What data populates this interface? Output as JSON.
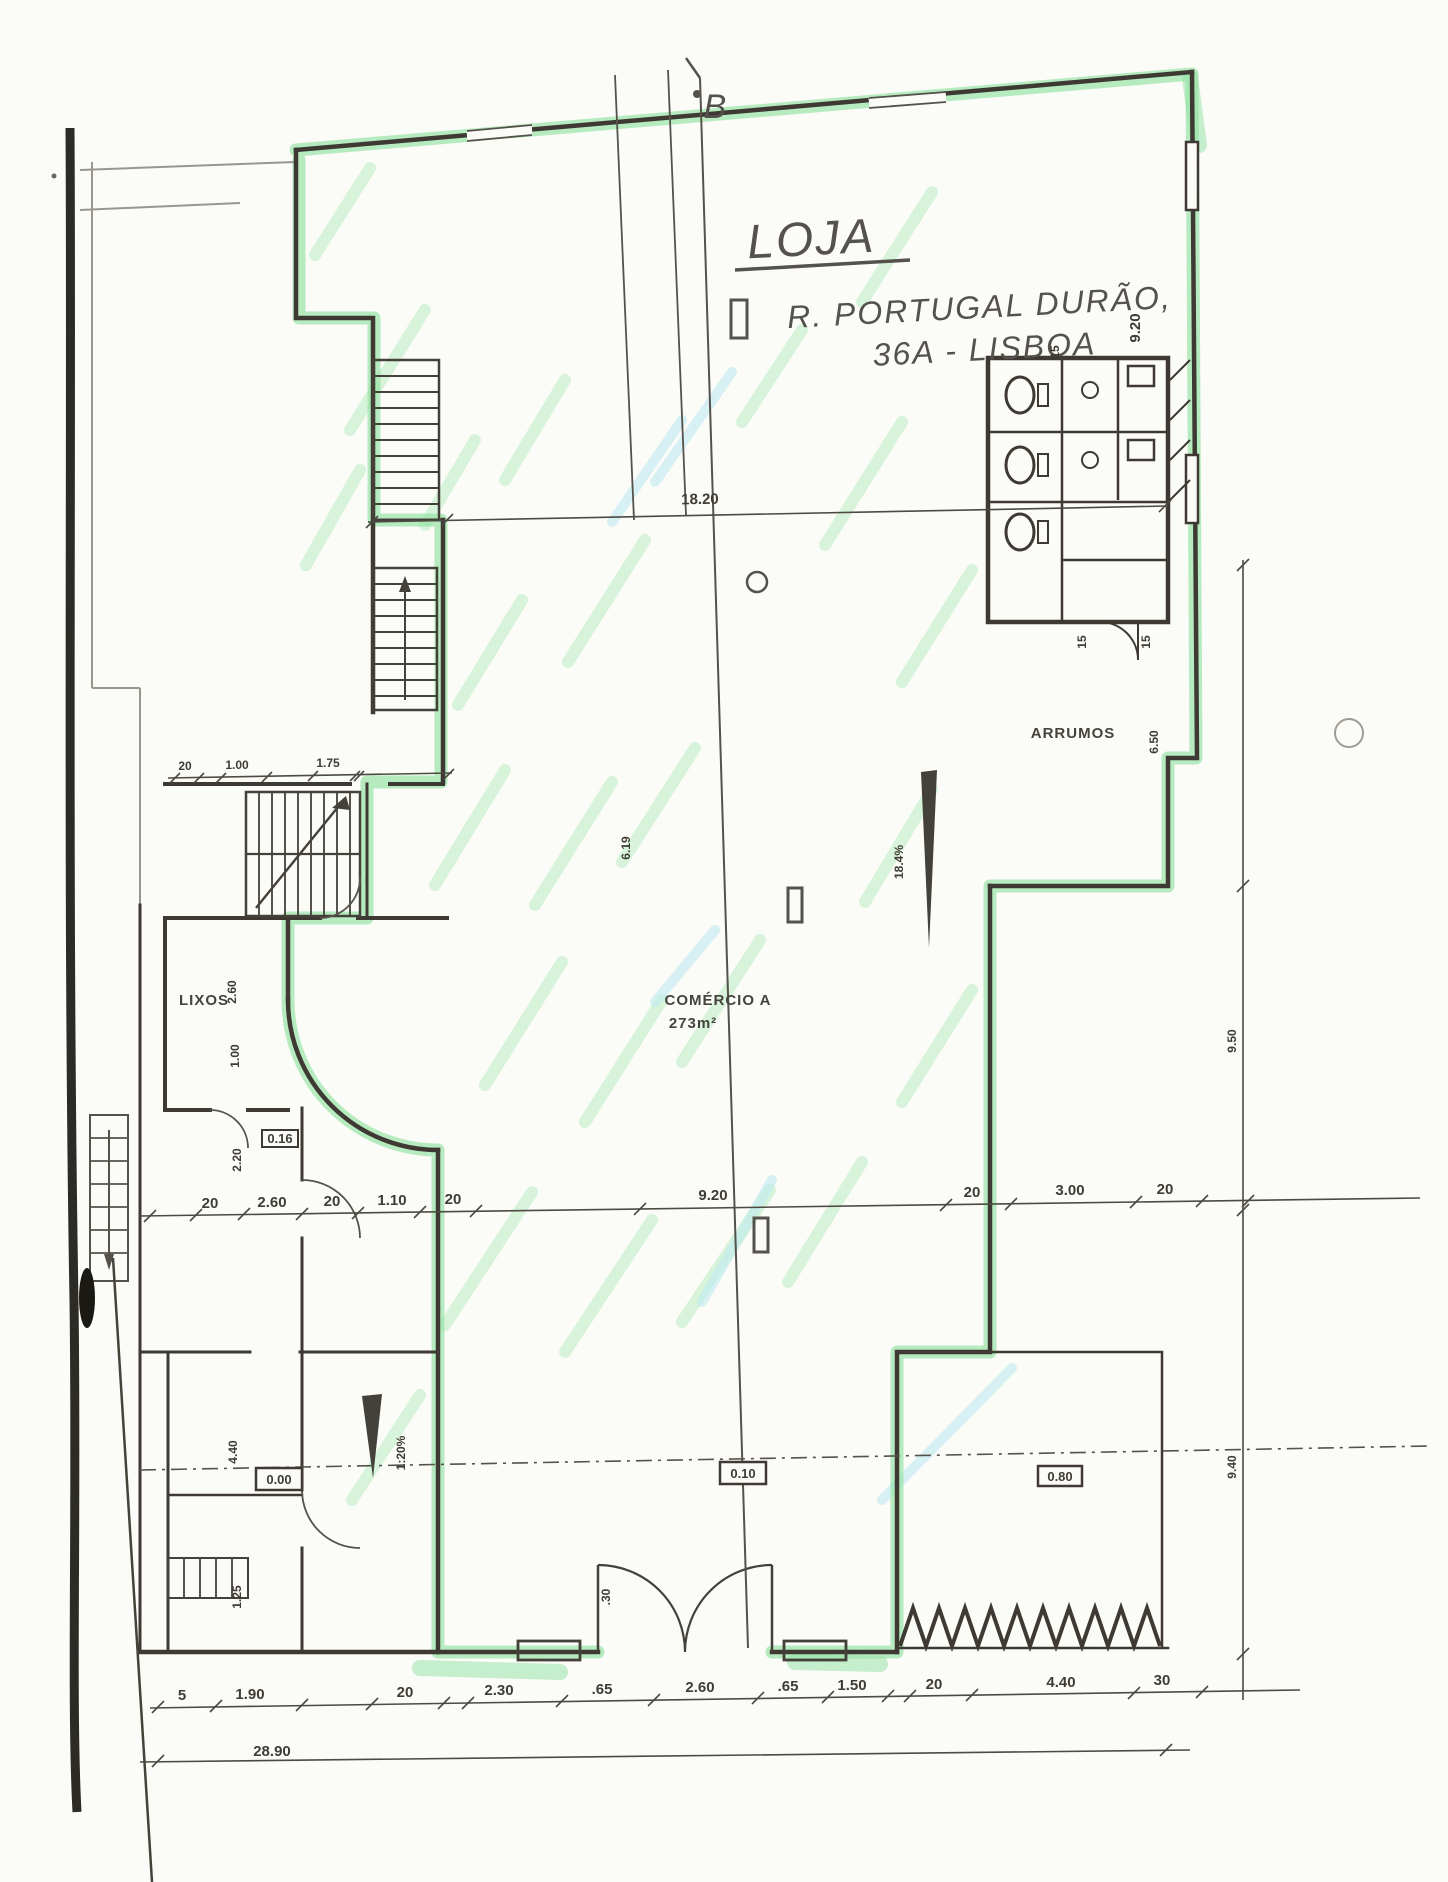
{
  "plan": {
    "handwritten_title": "LOJA",
    "handwritten_address1": "R. PORTUGAL DURÃO,",
    "handwritten_address2": "36A - LISBOA",
    "section_label": "B",
    "room_labels": {
      "arrumos": "ARRUMOS",
      "comercio_name": "COMÉRCIO A",
      "comercio_area": "273m²",
      "lixos": "LIXOS"
    },
    "levels": {
      "entrance": "0.00",
      "mid": "0.10",
      "right": "0.80",
      "small": "0.16"
    },
    "slopes": {
      "ramp_left": "1:20%",
      "ramp_right": "18.4%"
    },
    "dimensions": {
      "top_total": "18.20",
      "middle_row": [
        "20",
        "2.60",
        "20",
        "1.10",
        "20",
        "9.20",
        "20",
        "3.00",
        "20"
      ],
      "bottom_row": [
        "5",
        "1.90",
        "20",
        "2.30",
        ".65",
        "2.60",
        ".65",
        "1.50",
        "20",
        "4.40",
        "30"
      ],
      "bottom_total": "28.90",
      "upper_left_row": [
        "20",
        "1.00",
        "1.75"
      ],
      "left_column": [
        "2.60",
        "1.00",
        "2.20",
        "4.40",
        "1.25"
      ],
      "right_column": [
        "9.20",
        "6.50",
        "9.50",
        "9.40"
      ],
      "center_vertical": "6.19",
      "wc_offsets": [
        "15",
        "15",
        "15"
      ],
      "door_width": ".30"
    }
  }
}
